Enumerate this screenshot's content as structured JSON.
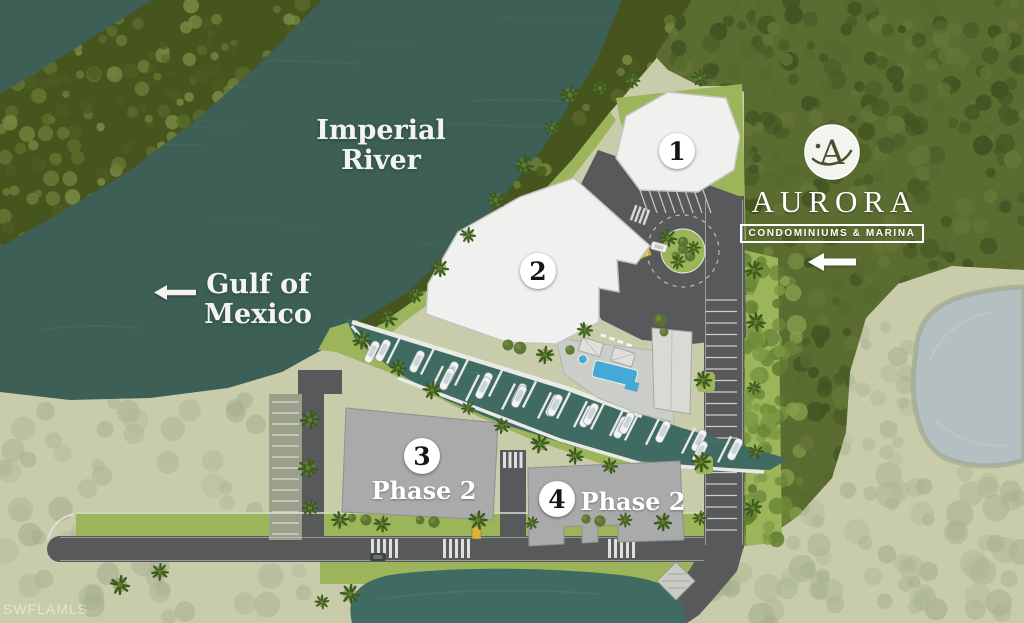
{
  "labels": {
    "river": "Imperial River",
    "gulf": "Gulf of Mexico"
  },
  "buildings": [
    {
      "number": "1",
      "phase": ""
    },
    {
      "number": "2",
      "phase": ""
    },
    {
      "number": "3",
      "phase": "Phase 2"
    },
    {
      "number": "4",
      "phase": "Phase 2"
    }
  ],
  "logo": {
    "monogram": "A",
    "name": "AURORA",
    "tagline": "CONDOMINIUMS & MARINA"
  },
  "watermark": "SWFLAMLS",
  "icons": [
    "left-arrow-icon",
    "entrance-left-arrow-icon",
    "aurora-monogram"
  ],
  "colors": {
    "land": "#c8ccab",
    "water": "#3d5f55",
    "marina": "#3f6b62",
    "pond": "#b3bfc1",
    "lawn": "#9cb45a",
    "road": "#57595b",
    "building_white": "#f0f1ef",
    "building_gray": "#a9abaa",
    "pool": "#45a9d6",
    "dense_trees": "#5b6c31",
    "mangrove": "#46551d",
    "dock": "#e9eae6"
  }
}
